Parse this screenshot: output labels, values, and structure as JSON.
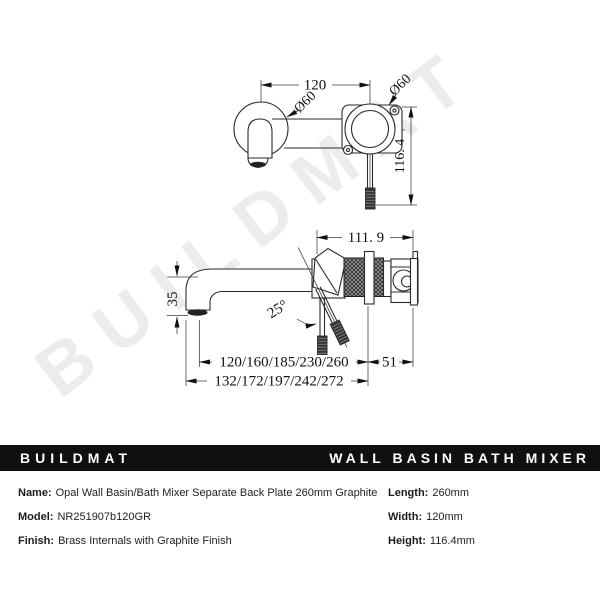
{
  "watermark": "BUILDMAT",
  "banner": {
    "brand": "BUILDMAT",
    "product": "WALL BASIN BATH MIXER",
    "background": "#101010",
    "text_color": "#ffffff"
  },
  "drawing": {
    "front_view": {
      "center_distance": "120",
      "plate_diameter_left": "Ø60",
      "plate_diameter_right": "Ø60",
      "overall_height": "116. 4"
    },
    "side_view": {
      "body_depth": "111. 9",
      "spout_drop": "35",
      "handle_angle": "25°",
      "spout_projection_options": "120/160/185/230/260",
      "overall_projection_options": "132/172/197/242/272",
      "handle_offset": "51"
    }
  },
  "specs": {
    "left": [
      {
        "label": "Name:",
        "value": "Opal Wall Basin/Bath Mixer Separate Back Plate 260mm Graphite"
      },
      {
        "label": "Model:",
        "value": "NR251907b120GR"
      },
      {
        "label": "Finish:",
        "value": "Brass Internals with Graphite Finish"
      }
    ],
    "right": [
      {
        "label": "Length:",
        "value": "260mm"
      },
      {
        "label": "Width:",
        "value": "120mm"
      },
      {
        "label": "Height:",
        "value": "116.4mm"
      }
    ]
  }
}
